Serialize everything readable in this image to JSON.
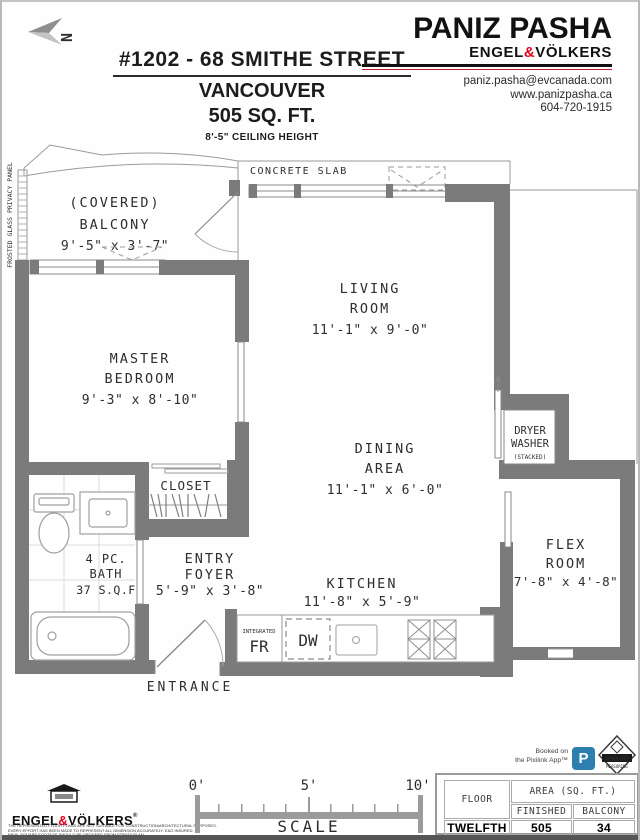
{
  "header": {
    "north": "N",
    "address": "#1202 - 68 SMITHE STREET",
    "city": "VANCOUVER",
    "area": "505 SQ. FT.",
    "ceiling": "8'-5\" CEILING HEIGHT",
    "agent_name": "PANIZ PASHA",
    "brand_left": "ENGEL",
    "brand_amp": "&",
    "brand_right": "VÖLKERS",
    "email": "paniz.pasha@evcanada.com",
    "website": "www.panizpasha.ca",
    "phone": "604-720-1915"
  },
  "plan": {
    "labels": {
      "frosted_panel": "FROSTED GLASS PRIVACY PANEL",
      "concrete_slab": "CONCRETE SLAB",
      "balcony": [
        "(COVERED)",
        "BALCONY",
        "9'-5\" x 3'-7\""
      ],
      "living": [
        "LIVING",
        "ROOM",
        "11'-1\" x 9'-0\""
      ],
      "master": [
        "MASTER",
        "BEDROOM",
        "9'-3\" x 8'-10\""
      ],
      "dining": [
        "DINING",
        "AREA",
        "11'-1\" x 6'-0\""
      ],
      "laundry": [
        "DRYER",
        "WASHER",
        "(STACKED)"
      ],
      "closet": "CLOSET",
      "bath": [
        "4 PC.",
        "BATH",
        "37 S.Q.F"
      ],
      "foyer": [
        "ENTRY",
        "FOYER",
        "5'-9\" x 3'-8\""
      ],
      "kitchen": [
        "KITCHEN",
        "11'-8\" x 5'-9\""
      ],
      "flex": [
        "FLEX",
        "ROOM",
        "7'-8\" x 4'-8\""
      ],
      "integrated": "INTEGRATED",
      "fridge": "FR",
      "dishwasher": "DW",
      "entrance": "ENTRANCE"
    }
  },
  "footer": {
    "brand_left": "ENGEL",
    "brand_amp": "&",
    "brand_right": "VÖLKERS",
    "reg": "®",
    "disclaimer": [
      "THE REPRESENTED FLOOR PLANS ARE NOT SUITABLE FOR CONSTRUCTION/ARCHITECTURAL PURPOSES.",
      "EVERY EFFORT HAS BEEN MADE TO REPRESENT ALL DIMENSION ACCURATELY. E&O INSURED.",
      "FINAL SQUARE FOOTAGE SHOULD BE OBTAINED FROM STRATA PLAN"
    ],
    "scale": {
      "zero": "0'",
      "five": "5'",
      "ten": "10'",
      "label": "SCALE"
    },
    "booked_line1": "Booked on",
    "booked_line2": "the Pixilink App™",
    "p_badge": "P",
    "absolute_line1": "ABSOLUTE",
    "absolute_line2": "MEASURING",
    "table": {
      "floor": "FLOOR",
      "area": "AREA (SQ. FT.)",
      "finished": "FINISHED",
      "balcony": "BALCONY",
      "row_floor": "TWELFTH",
      "row_finished": "505",
      "row_balcony": "34"
    }
  },
  "colors": {
    "wall_gray": "#7b7b7b",
    "accent_red": "#e2001a",
    "pixilink_blue": "#2d7fb0"
  }
}
